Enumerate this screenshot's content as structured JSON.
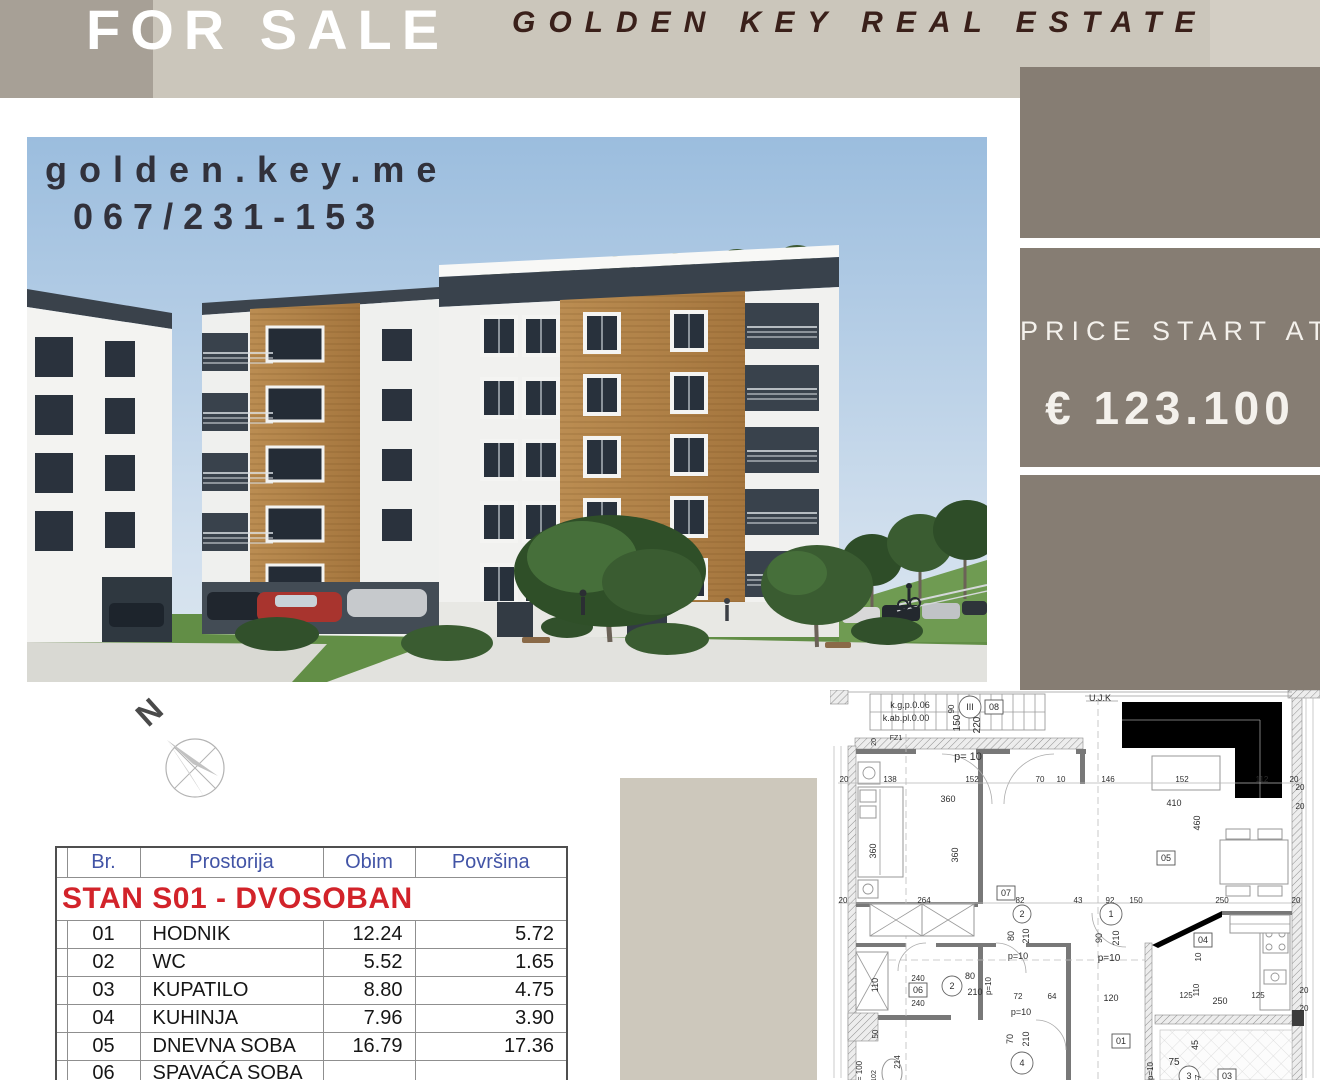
{
  "banner": {
    "for_sale": "FOR SALE",
    "brand": "GOLDEN KEY REAL ESTATE"
  },
  "photo": {
    "website": "golden.key.me",
    "phone": "067/231-153"
  },
  "price": {
    "label": "PRICE START AT",
    "value": "€ 123.100"
  },
  "compass": {
    "north_label": "N"
  },
  "table": {
    "columns": [
      "",
      "Br.",
      "Prostorija",
      "Obim",
      "Površina"
    ],
    "section_header": "STAN S01 - DVOSOBAN",
    "rows": [
      [
        "01",
        "HODNIK",
        "12.24",
        "5.72"
      ],
      [
        "02",
        "WC",
        "5.52",
        "1.65"
      ],
      [
        "03",
        "KUPATILO",
        "8.80",
        "4.75"
      ],
      [
        "04",
        "KUHINJA",
        "7.96",
        "3.90"
      ],
      [
        "05",
        "DNEVNA SOBA",
        "16.79",
        "17.36"
      ],
      [
        "06",
        "SPAVAĆA SOBA",
        "",
        ""
      ]
    ]
  },
  "colors": {
    "page_bg": "#ffffff",
    "banner_left": "#a7a096",
    "banner": "#cbc6bb",
    "banner_right": "#d3cec4",
    "brand_text": "#3a201a",
    "block": "#867d73",
    "price_text": "#f4f1ec",
    "table_header_text": "#4254a6",
    "section_text": "#d2232a",
    "panel": "#cdc8bc"
  },
  "floorplan": {
    "items": [
      [
        "st",
        40,
        4,
        175,
        36,
        11
      ],
      [
        "r",
        0,
        0,
        18,
        14,
        "hatch"
      ],
      [
        "l",
        18,
        2,
        255,
        2,
        "thin"
      ],
      [
        "r",
        25,
        48,
        228,
        11,
        "hatch"
      ],
      [
        "r",
        18,
        56,
        8,
        334,
        "hatch"
      ],
      [
        "r",
        462,
        6,
        10,
        384,
        "hatch"
      ],
      [
        "r",
        458,
        0,
        32,
        8,
        "hatch"
      ],
      [
        "l",
        255,
        2,
        462,
        2,
        "thin"
      ],
      [
        "l",
        255,
        6,
        462,
        6,
        "thin"
      ],
      [
        "r",
        26,
        59,
        60,
        5,
        "wall"
      ],
      [
        "r",
        146,
        59,
        34,
        5,
        "wall"
      ],
      [
        "r",
        246,
        59,
        10,
        5,
        "wall"
      ],
      [
        "r",
        148,
        64,
        5,
        150,
        "wall"
      ],
      [
        "r",
        250,
        64,
        5,
        30,
        "wall"
      ],
      [
        "r",
        26,
        212,
        122,
        5,
        "wall"
      ],
      [
        "r",
        26,
        253,
        50,
        4,
        "wall"
      ],
      [
        "r",
        106,
        253,
        60,
        4,
        "wall"
      ],
      [
        "r",
        196,
        253,
        40,
        4,
        "wall"
      ],
      [
        "r",
        26,
        325,
        95,
        5,
        "wall"
      ],
      [
        "r",
        148,
        253,
        5,
        77,
        "wall"
      ],
      [
        "r",
        236,
        253,
        5,
        137,
        "wall"
      ],
      [
        "r",
        315,
        253,
        7,
        137,
        "hatch"
      ],
      [
        "p",
        "M322,255 L392,221 L392,227 L328,258 Z",
        "wallP"
      ],
      [
        "r",
        392,
        221,
        70,
        4,
        "wall"
      ],
      [
        "r",
        325,
        325,
        137,
        9,
        "hatch"
      ],
      [
        "r",
        462,
        320,
        12,
        16,
        "dark"
      ],
      [
        "r",
        18,
        323,
        30,
        28,
        "hatch"
      ],
      [
        "l",
        76,
        44,
        76,
        390,
        "dash"
      ],
      [
        "l",
        268,
        8,
        268,
        390,
        "dash"
      ],
      [
        "l",
        26,
        270,
        315,
        270,
        "dash"
      ],
      [
        "r",
        28,
        72,
        22,
        22,
        "furn"
      ],
      [
        "c",
        39,
        83,
        6,
        "furnS"
      ],
      [
        "r",
        28,
        97,
        45,
        90,
        "furn"
      ],
      [
        "l",
        50,
        99,
        50,
        185,
        "thin"
      ],
      [
        "r",
        30,
        100,
        16,
        12,
        "furn"
      ],
      [
        "r",
        30,
        116,
        16,
        12,
        "furn"
      ],
      [
        "r",
        28,
        190,
        20,
        18,
        "furn"
      ],
      [
        "c",
        38,
        199,
        5,
        "furnS"
      ],
      [
        "x",
        40,
        214,
        52,
        32
      ],
      [
        "x",
        92,
        214,
        52,
        32
      ],
      [
        "x",
        26,
        262,
        32,
        58
      ],
      [
        "e",
        62,
        383,
        10,
        14
      ],
      [
        "p",
        "M292,12 L452,12 L452,108 L405,108 L405,58 L292,58 Z",
        "furnP"
      ],
      [
        "l",
        292,
        30,
        430,
        30,
        "thin"
      ],
      [
        "l",
        430,
        30,
        430,
        108,
        "thin"
      ],
      [
        "r",
        322,
        66,
        68,
        34,
        "furn"
      ],
      [
        "r",
        390,
        150,
        68,
        44,
        "furn"
      ],
      [
        "r",
        396,
        139,
        24,
        10,
        "furn"
      ],
      [
        "r",
        428,
        139,
        24,
        10,
        "furn"
      ],
      [
        "r",
        396,
        196,
        24,
        10,
        "furn"
      ],
      [
        "r",
        428,
        196,
        24,
        10,
        "furn"
      ],
      [
        "r",
        430,
        228,
        30,
        92,
        "furn"
      ],
      [
        "r",
        433,
        238,
        25,
        25,
        "furn"
      ],
      [
        "c",
        439,
        244,
        3,
        "furnS"
      ],
      [
        "c",
        452,
        244,
        3,
        "furnS"
      ],
      [
        "c",
        439,
        257,
        3,
        "furnS"
      ],
      [
        "c",
        452,
        257,
        3,
        "furnS"
      ],
      [
        "r",
        434,
        280,
        22,
        14,
        "furn"
      ],
      [
        "c",
        445,
        287,
        4,
        "furnS"
      ],
      [
        "r",
        400,
        225,
        60,
        18,
        "furn"
      ],
      [
        "l",
        400,
        234,
        460,
        234,
        "thin"
      ],
      [
        "r",
        330,
        340,
        132,
        50,
        "tile"
      ],
      [
        "p",
        "M112,64 A50,50 0 0 1 162,114",
        "arc"
      ],
      [
        "p",
        "M224,64 A50,50 0 0 0 174,114",
        "arc"
      ],
      [
        "p",
        "M96,253 A28,28 0 0 0 68,281",
        "arc"
      ],
      [
        "p",
        "M166,253 A30,30 0 0 1 196,283",
        "arc"
      ],
      [
        "p",
        "M206,330 A30,30 0 0 1 236,360",
        "arc"
      ],
      [
        "p",
        "M262,223 A34,34 0 0 0 296,257",
        "arc"
      ],
      [
        "l",
        8,
        93,
        472,
        93,
        "dim"
      ],
      [
        "l",
        8,
        213,
        472,
        213,
        "dim"
      ],
      [
        "l",
        4,
        56,
        4,
        388,
        "dim"
      ],
      [
        "l",
        11,
        56,
        11,
        388,
        "dim"
      ],
      [
        "l",
        476,
        8,
        476,
        388,
        "dim"
      ],
      [
        "l",
        483,
        8,
        483,
        388,
        "dim"
      ],
      [
        "l",
        256,
        11,
        288,
        11,
        "thin"
      ],
      [
        "t",
        80,
        15,
        "k.g.p.0.06",
        9,
        0
      ],
      [
        "t",
        76,
        28,
        "k.ab.pl.0.00",
        9,
        0
      ],
      [
        "tc",
        140,
        17,
        11,
        "III"
      ],
      [
        "tb",
        164,
        17,
        "08"
      ],
      [
        "t",
        124,
        16,
        "90",
        8,
        -90
      ],
      [
        "t",
        130,
        30,
        "150",
        10,
        -90
      ],
      [
        "t",
        150,
        32,
        "220",
        10,
        -90
      ],
      [
        "t",
        46,
        49,
        "20",
        7,
        -90
      ],
      [
        "t",
        66,
        47,
        "FZ1",
        7,
        0
      ],
      [
        "t",
        138,
        67,
        "p= 10",
        11,
        0
      ],
      [
        "t",
        14,
        89,
        "20",
        8,
        0
      ],
      [
        "t",
        60,
        89,
        "138",
        8,
        0
      ],
      [
        "t",
        142,
        89,
        "152",
        8,
        0
      ],
      [
        "t",
        210,
        89,
        "70",
        8,
        0
      ],
      [
        "t",
        231,
        89,
        "10",
        8,
        0
      ],
      [
        "t",
        278,
        89,
        "146",
        8,
        0
      ],
      [
        "t",
        352,
        89,
        "152",
        8,
        0
      ],
      [
        "t",
        432,
        89,
        "112",
        8,
        0
      ],
      [
        "t",
        464,
        89,
        "20",
        8,
        0
      ],
      [
        "t",
        118,
        109,
        "360",
        9,
        0
      ],
      [
        "t",
        46,
        158,
        "360",
        9,
        -90
      ],
      [
        "t",
        128,
        162,
        "360",
        9,
        -90
      ],
      [
        "t",
        344,
        113,
        "410",
        9,
        0
      ],
      [
        "t",
        370,
        130,
        "460",
        9,
        -90
      ],
      [
        "tb",
        336,
        168,
        "05"
      ],
      [
        "t",
        270,
        8,
        "U.J.K",
        9,
        0
      ],
      [
        "t",
        13,
        210,
        "20",
        8,
        0
      ],
      [
        "t",
        94,
        210,
        "264",
        8,
        0
      ],
      [
        "tb",
        176,
        203,
        "07"
      ],
      [
        "t",
        190,
        210,
        "82",
        8,
        0
      ],
      [
        "tc",
        192,
        224,
        9,
        "2"
      ],
      [
        "t",
        184,
        243,
        "80",
        9,
        -90
      ],
      [
        "t",
        199,
        243,
        "210",
        9,
        -90
      ],
      [
        "t",
        188,
        266,
        "p=10",
        9,
        0
      ],
      [
        "t",
        48,
        292,
        "110",
        9,
        -90
      ],
      [
        "t",
        88,
        288,
        "240",
        8,
        0
      ],
      [
        "tb",
        88,
        300,
        "06"
      ],
      [
        "t",
        88,
        313,
        "240",
        8,
        0
      ],
      [
        "tc",
        122,
        296,
        10,
        "2"
      ],
      [
        "t",
        140,
        286,
        "80",
        9,
        0
      ],
      [
        "t",
        145,
        302,
        "210",
        9,
        0
      ],
      [
        "t",
        161,
        293,
        "p=10",
        8,
        -90
      ],
      [
        "t",
        188,
        306,
        "72",
        8,
        0
      ],
      [
        "t",
        222,
        306,
        "64",
        8,
        0
      ],
      [
        "t",
        191,
        322,
        "p=10",
        9,
        0
      ],
      [
        "t",
        183,
        346,
        "70",
        9,
        -90
      ],
      [
        "t",
        199,
        346,
        "210",
        9,
        -90
      ],
      [
        "tc",
        192,
        373,
        11,
        "4"
      ],
      [
        "t",
        48,
        341,
        "50",
        8,
        -90
      ],
      [
        "t",
        32,
        378,
        "= 100",
        8,
        -90
      ],
      [
        "t",
        46,
        383,
        "102",
        7,
        -90
      ],
      [
        "t",
        70,
        369,
        "214",
        8,
        -90
      ],
      [
        "t",
        248,
        210,
        "43",
        8,
        0
      ],
      [
        "t",
        280,
        210,
        "92",
        8,
        0
      ],
      [
        "t",
        306,
        210,
        "150",
        8,
        0
      ],
      [
        "t",
        392,
        210,
        "250",
        8,
        0
      ],
      [
        "t",
        466,
        210,
        "20",
        8,
        0
      ],
      [
        "tc",
        281,
        224,
        11,
        "1"
      ],
      [
        "t",
        272,
        245,
        "90",
        9,
        -90
      ],
      [
        "t",
        289,
        245,
        "210",
        9,
        -90
      ],
      [
        "t",
        279,
        268,
        "p=10",
        10,
        0
      ],
      [
        "tb",
        373,
        250,
        "04"
      ],
      [
        "t",
        371,
        264,
        "10",
        8,
        -90
      ],
      [
        "t",
        281,
        308,
        "120",
        9,
        0
      ],
      [
        "t",
        356,
        305,
        "125",
        8,
        0
      ],
      [
        "t",
        428,
        305,
        "125",
        8,
        0
      ],
      [
        "t",
        369,
        297,
        "110",
        8,
        -90
      ],
      [
        "t",
        390,
        311,
        "250",
        9,
        0
      ],
      [
        "t",
        474,
        300,
        "20",
        8,
        0
      ],
      [
        "t",
        474,
        318,
        "20",
        8,
        0
      ],
      [
        "t",
        470,
        97,
        "20",
        8,
        0
      ],
      [
        "t",
        470,
        116,
        "20",
        8,
        0
      ],
      [
        "t",
        368,
        352,
        "45",
        9,
        -90
      ],
      [
        "tb",
        291,
        351,
        "01"
      ],
      [
        "t",
        344,
        372,
        "75",
        10,
        0
      ],
      [
        "t",
        323,
        378,
        "p=10",
        8,
        -90
      ],
      [
        "tc",
        359,
        386,
        10,
        "3"
      ],
      [
        "t",
        371,
        386,
        "77",
        8,
        -90
      ],
      [
        "tb",
        397,
        386,
        "03"
      ]
    ]
  }
}
